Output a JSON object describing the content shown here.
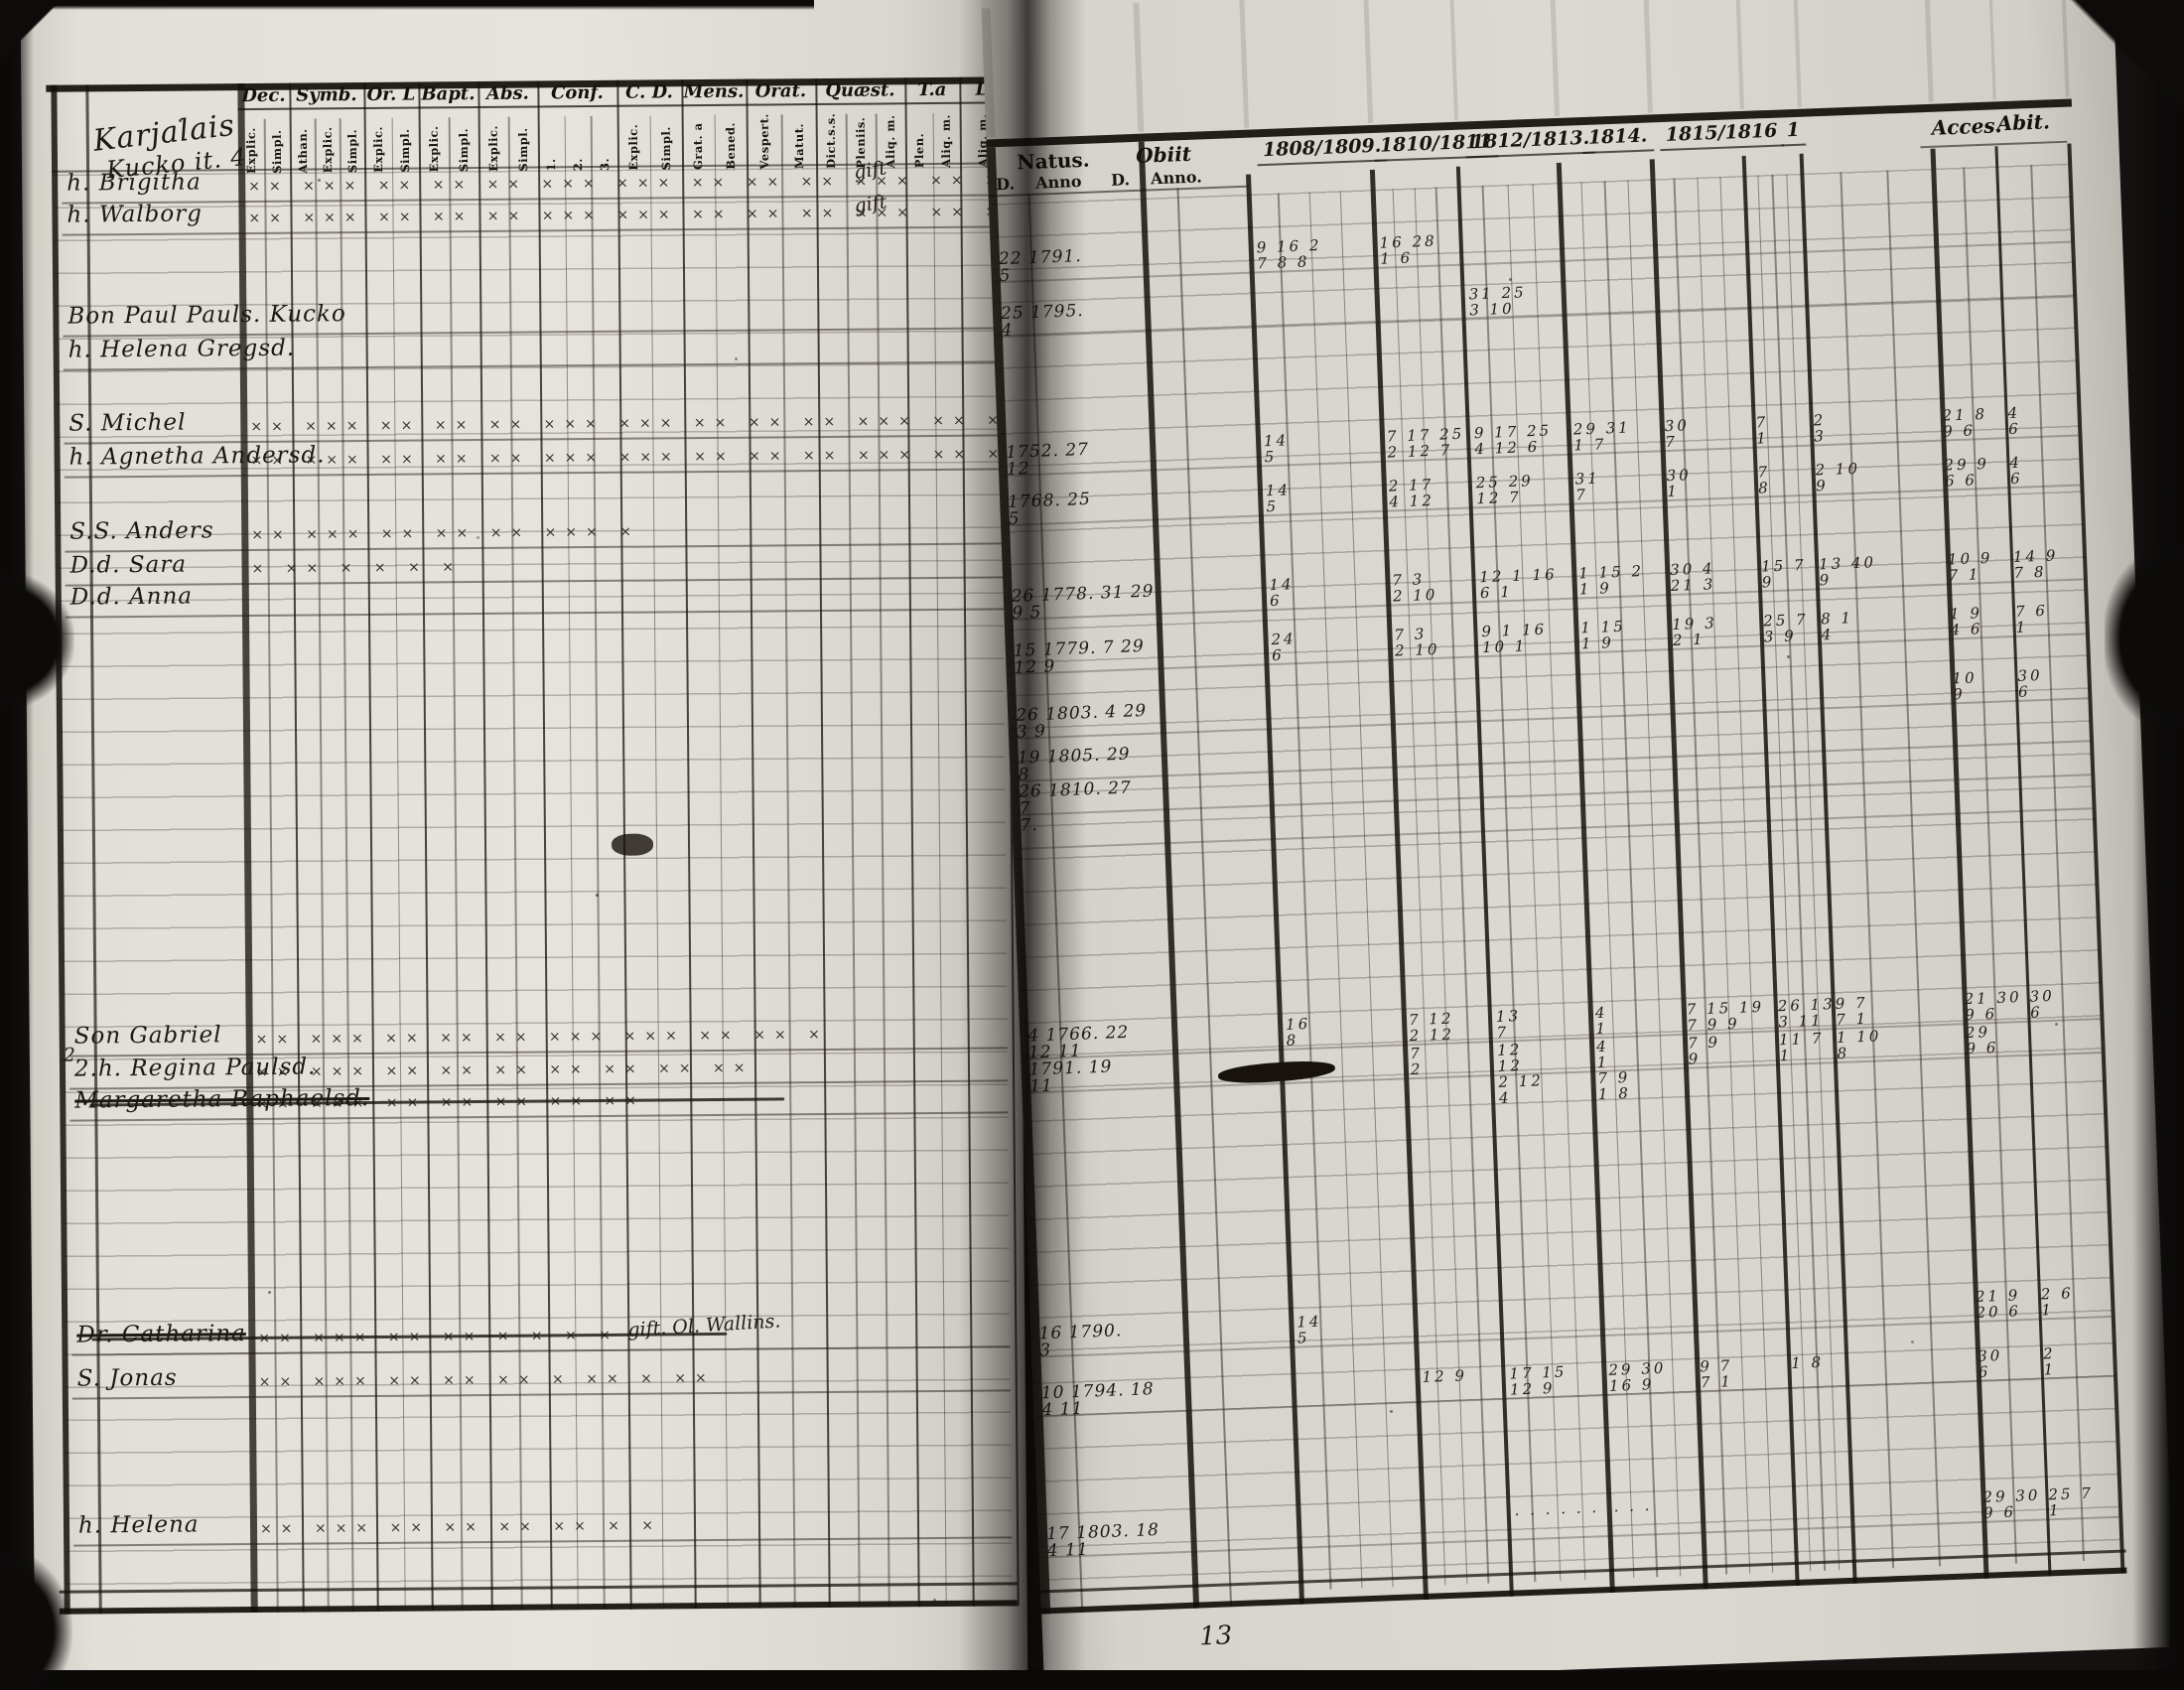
{
  "title": {
    "line1": "Karjalais",
    "line2": "Kucko it. 4"
  },
  "left_header": {
    "groups": [
      {
        "label": "Dec.",
        "subs": [
          "Explic.",
          "Simpl."
        ]
      },
      {
        "label": "Symb.",
        "subs": [
          "Athan.",
          "Explic.",
          "Simpl."
        ]
      },
      {
        "label": "Or. L",
        "subs": [
          "Explic.",
          "Simpl."
        ]
      },
      {
        "label": "Bapt.",
        "subs": [
          "Explic.",
          "Simpl."
        ]
      },
      {
        "label": "Abs.",
        "subs": [
          "Explic.",
          "Simpl."
        ]
      },
      {
        "label": "Conf.",
        "subs": [
          "1.",
          "2.",
          "3."
        ]
      },
      {
        "label": "C. D.",
        "subs": [
          "Explic.",
          "Simpl."
        ]
      },
      {
        "label": "Mens.",
        "subs": [
          "Grat. a",
          "Bened."
        ]
      },
      {
        "label": "Orat.",
        "subs": [
          "Vespert.",
          "Matut."
        ]
      },
      {
        "label": "Quæst.",
        "subs": [
          "Dict.s.s.",
          "Pleniis.",
          "Aliq. m."
        ]
      },
      {
        "label": "T.a",
        "subs": [
          "Plen.",
          "Aliq. m."
        ]
      },
      {
        "label": "L",
        "subs": [
          "Aliq. m."
        ]
      }
    ]
  },
  "right_header": {
    "natus_label": "Natus.",
    "natus_subs": [
      "D.",
      "Anno"
    ],
    "obiit_label": "Obiit",
    "obiit_subs": [
      "D.",
      "Anno."
    ],
    "years": [
      "1808/1809.",
      "1810/1811",
      "1812/1813.",
      "1814.",
      "1815/1816",
      "1"
    ],
    "acces_label": "Acces.",
    "abit_label": "Abit."
  },
  "annotations": {
    "gift1": "gift",
    "gift2": "gift",
    "wallin": "gift. Ol. Wallins.",
    "margin_no": "2.",
    "page_no": "13"
  },
  "rows": [
    {
      "name": "h. Brigitha",
      "marks": "×× ××× ×× ×× ×× ××× ××× ×× ×× ×× ××× ×× ××",
      "natus": "22 1791.|5",
      "g": [
        "9 16 2|7 8 8",
        "16 28|1 6",
        "",
        "",
        "",
        "",
        ""
      ],
      "acces": "",
      "abit": ""
    },
    {
      "name": "h. Walborg",
      "marks": "×× ××× ×× ×× ×× ××× ××× ×× ×× ×× ××× ×× ××",
      "natus": "25 1795.|4",
      "g": [
        "",
        "",
        "31 25|3 10",
        "",
        "",
        "",
        ""
      ],
      "acces": "",
      "abit": ""
    },
    {
      "name": "Bon Paul Pauls. Kucko",
      "marks": "",
      "natus": "1752. 27|12",
      "g": [
        "14|5",
        "7 17 25|2 12 7",
        "9 17 25|4 12 6",
        "29 31|1 7",
        "30|7",
        "7|1",
        "2|3"
      ],
      "acces": "21 8|9 6",
      "abit": "4|6"
    },
    {
      "name": "h. Helena Gregsd.",
      "marks": "",
      "natus": "1768. 25|5",
      "g": [
        "14|5",
        "2 17|4 12",
        "25 29|12 7",
        "31|7",
        "30|1",
        "7|8",
        "2 10|9"
      ],
      "acces": "29 9|6 6",
      "abit": "4|6"
    },
    {
      "name": "S. Michel",
      "marks": "×× ××× ×× ×× ×× ××× ××× ×× ×× ×× ××× ×× ××",
      "natus": "26 1778. 31 29|9 5",
      "g": [
        "14|6",
        "7 3|2 10",
        "12 1 16|6 1",
        "1 15 2|1 9",
        "30 4|21 3",
        "15 7|9",
        "13 40|9"
      ],
      "acces": "10 9|7 1",
      "abit": "14 9|7 8"
    },
    {
      "name": "h. Agnetha Andersd.",
      "marks": "×× ××× ×× ×× ×× ××× ××× ×× ×× ×× ××× ×× ××",
      "natus": "15 1779. 7 29|12 9",
      "g": [
        "24|6",
        "7 3|2 10",
        "9 1 16|10 1",
        "1 15|1 9",
        "19 3|2 1",
        "25 7|3 9",
        "8 1|4"
      ],
      "acces": "1 9|4 6",
      "abit": "7 6|1"
    },
    {
      "name": "S.S. Anders",
      "marks": "×× ××× ×× ×× ×× ××× ×",
      "natus": "26 1803. 4 29|3 9",
      "g": [
        "",
        "",
        "",
        "",
        "",
        "",
        ""
      ],
      "acces": "10|9",
      "abit": "30|6"
    },
    {
      "name": "D.d. Sara",
      "marks": "× ×× ×  ×  ×  ×",
      "natus": "19 1805. 29|8",
      "g": [
        "",
        "",
        "",
        "",
        "",
        "",
        ""
      ],
      "acces": "",
      "abit": ""
    },
    {
      "name": "D.d. Anna",
      "marks": "",
      "natus": "26 1810. 27|7",
      "g": [
        "",
        "",
        "",
        "",
        "",
        "",
        ""
      ],
      "acces": "",
      "abit": ""
    },
    {
      "name": "",
      "marks": "",
      "natus": "7.|",
      "g": [
        "",
        "",
        "",
        "",
        "",
        "",
        ""
      ],
      "acces": "",
      "abit": ""
    },
    {
      "name": "Son Gabriel",
      "marks": "×× ××× ×× ×× ×× ××× ××× ×× ×× ×",
      "natus": "4 1766. 22|12 11",
      "g": [
        "16|8",
        "7 12|2 12",
        "13|7",
        "4|1",
        "7 15 19|7 9 9",
        "26 13|3 11",
        "9 7|7 1"
      ],
      "acces": "21 30|9 6",
      "abit": "30|6"
    },
    {
      "name": "2.h. Regina Paulsd.",
      "marks": "×× ××× ×× ×× ×× ×× ××  ×× ××",
      "natus": "1791. 19|11",
      "g": [
        "",
        "7|2",
        "12|12",
        "4|1",
        "7 9|9",
        "11 7|1",
        "1 10|8"
      ],
      "acces": "29|9 6",
      "abit": ""
    },
    {
      "name": "Margaretha Raphaelsd.",
      "marks": "×× ××× ×× ×× ×× ×× ××",
      "natus": "",
      "g": [
        "",
        "",
        "2 12|4",
        "7 9|1 8",
        "",
        "",
        ""
      ],
      "acces": "",
      "abit": ""
    },
    {
      "name": "Dr. Catharina",
      "marks": "×× ××× ×× ×× × ×  ×  ×",
      "natus": "16 1790.|3",
      "g": [
        "14|5",
        "",
        "",
        "",
        "",
        "",
        ""
      ],
      "acces": "21 9|20 6",
      "abit": "2 6|1"
    },
    {
      "name": "S. Jonas",
      "marks": "×× ××× ×× ×× ×× × ××  × ××",
      "natus": "10 1794. 18|4 11",
      "g": [
        "",
        "12 9",
        "17 15|12 9",
        "29 30|16 9",
        "9 7|7 1",
        "1 8",
        ""
      ],
      "acces": "30|6",
      "abit": "2|1"
    },
    {
      "name": "h. Helena",
      "marks": "×× ××× ×× ×× ×× ××  × ×",
      "natus": "17 1803. 18|4 11",
      "g": [
        "",
        "",
        "· · · · · ·",
        "· · ·",
        "",
        "",
        ""
      ],
      "acces": "29 30|9 6",
      "abit": "25 7|1"
    }
  ]
}
